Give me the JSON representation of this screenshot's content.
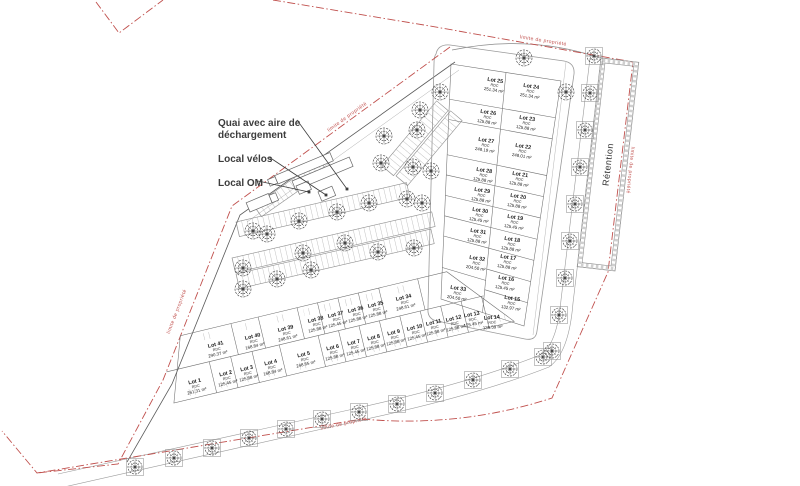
{
  "annotations": {
    "quai_line1": "Quai avec aire de",
    "quai_line2": "déchargement",
    "velos": "Local vélos",
    "om": "Local OM"
  },
  "labels": {
    "retention": "Rétention",
    "limite": "limite de propriété"
  },
  "colors": {
    "boundary_red": "#c0504d",
    "plan_line_grey": "#6e6e6e"
  },
  "lots": [
    {
      "name": "Lot 1",
      "floor": "RDC",
      "area": "261.31 m²"
    },
    {
      "name": "Lot 2",
      "floor": "RDC",
      "area": "125.45 m²"
    },
    {
      "name": "Lot 3",
      "floor": "RDC",
      "area": "125.88 m²"
    },
    {
      "name": "Lot 4",
      "floor": "RDC",
      "area": "168.84 m²"
    },
    {
      "name": "Lot 5",
      "floor": "RDC",
      "area": "248.65 m²"
    },
    {
      "name": "Lot 6",
      "floor": "RDC",
      "area": "125.88 m²"
    },
    {
      "name": "Lot 7",
      "floor": "RDC",
      "area": "125.45 m²"
    },
    {
      "name": "Lot 8",
      "floor": "RDC",
      "area": "125.88 m²"
    },
    {
      "name": "Lot 9",
      "floor": "RDC",
      "area": "125.88 m²"
    },
    {
      "name": "Lot 10",
      "floor": "RDC",
      "area": "125.45 m²"
    },
    {
      "name": "Lot 11",
      "floor": "RDC",
      "area": "125.88 m²"
    },
    {
      "name": "Lot 12",
      "floor": "RDC",
      "area": "125.88 m²"
    },
    {
      "name": "Lot 13",
      "floor": "RDC",
      "area": "125.45 m²"
    },
    {
      "name": "Lot 14",
      "floor": "RDC",
      "area": "139.59 m²"
    },
    {
      "name": "Lot 15",
      "floor": "RDC",
      "area": "132.97 m²"
    },
    {
      "name": "Lot 16",
      "floor": "RDC",
      "area": "125.45 m²"
    },
    {
      "name": "Lot 17",
      "floor": "RDC",
      "area": "125.88 m²"
    },
    {
      "name": "Lot 18",
      "floor": "RDC",
      "area": "125.88 m²"
    },
    {
      "name": "Lot 19",
      "floor": "RDC",
      "area": "125.45 m²"
    },
    {
      "name": "Lot 20",
      "floor": "RDC",
      "area": "125.88 m²"
    },
    {
      "name": "Lot 21",
      "floor": "RDC",
      "area": "125.88 m²"
    },
    {
      "name": "Lot 22",
      "floor": "RDC",
      "area": "248.01 m²"
    },
    {
      "name": "Lot 23",
      "floor": "RDC",
      "area": "125.88 m²"
    },
    {
      "name": "Lot 24",
      "floor": "RDC",
      "area": "251.34 m²"
    },
    {
      "name": "Lot 25",
      "floor": "RDC",
      "area": "251.34 m²"
    },
    {
      "name": "Lot 26",
      "floor": "RDC",
      "area": "125.88 m²"
    },
    {
      "name": "Lot 27",
      "floor": "RDC",
      "area": "248.19 m²"
    },
    {
      "name": "Lot 28",
      "floor": "RDC",
      "area": "125.88 m²"
    },
    {
      "name": "Lot 29",
      "floor": "RDC",
      "area": "125.88 m²"
    },
    {
      "name": "Lot 30",
      "floor": "RDC",
      "area": "125.45 m²"
    },
    {
      "name": "Lot 31",
      "floor": "RDC",
      "area": "125.88 m²"
    },
    {
      "name": "Lot 32",
      "floor": "RDC",
      "area": "204.50 m²"
    },
    {
      "name": "Lot 33",
      "floor": "RDC",
      "area": "204.50 m²"
    },
    {
      "name": "Lot 34",
      "floor": "RDC",
      "area": "248.61 m²"
    },
    {
      "name": "Lot 35",
      "floor": "RDC",
      "area": "125.88 m²"
    },
    {
      "name": "Lot 36",
      "floor": "RDC",
      "area": "125.88 m²"
    },
    {
      "name": "Lot 37",
      "floor": "RDC",
      "area": "125.45 m²"
    },
    {
      "name": "Lot 38",
      "floor": "RDC",
      "area": "125.88 m²"
    },
    {
      "name": "Lot 39",
      "floor": "RDC",
      "area": "248.61 m²"
    },
    {
      "name": "Lot 40",
      "floor": "RDC",
      "area": "168.84 m²"
    },
    {
      "name": "Lot 41",
      "floor": "RDC",
      "area": "290.37 m²"
    }
  ]
}
